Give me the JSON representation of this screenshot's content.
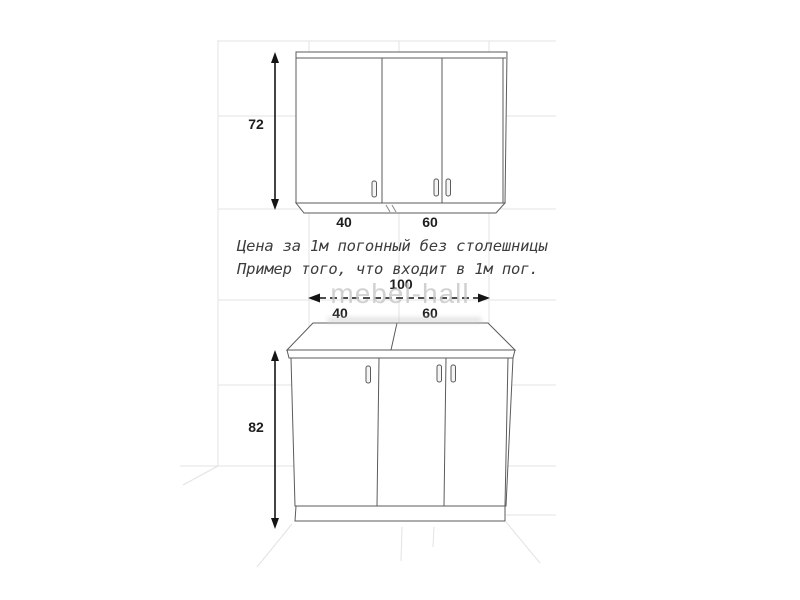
{
  "diagram": {
    "notes": {
      "line1": "Цена за 1м погонный без столешницы",
      "line2": "Пример того, что входит в 1м пог."
    },
    "upper_cabinet": {
      "height_label": "72",
      "section_labels": [
        "40",
        "60"
      ]
    },
    "lower_cabinet": {
      "height_label": "82",
      "total_width_label": "100",
      "section_labels": [
        "40",
        "60"
      ]
    },
    "watermark": "mebel-hall",
    "colors": {
      "background": "#ffffff",
      "line": "#5b5b5b",
      "grid": "#e3e3e3",
      "dimension": "#141414",
      "text": "#3d3d3d",
      "watermark": "#c9c9c9"
    }
  }
}
